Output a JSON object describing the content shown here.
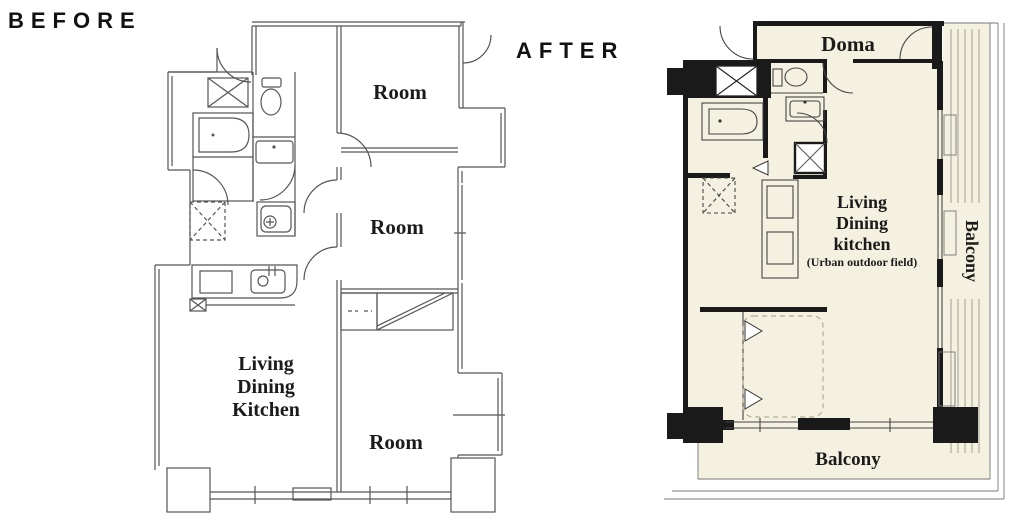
{
  "labels": {
    "before": "BEFORE",
    "after": "AFTER"
  },
  "before_plan": {
    "rooms": {
      "top": "Room",
      "middle": "Room",
      "bottom": "Room"
    },
    "ldk": [
      "Living",
      "Dining",
      "Kitchen"
    ]
  },
  "after_plan": {
    "doma": "Doma",
    "ldk": [
      "Living",
      "Dining",
      "kitchen",
      "(Urban outdoor field)"
    ],
    "balcony_right": "Balcony",
    "balcony_bottom": "Balcony"
  },
  "colors": {
    "canvas_bg": "#ffffff",
    "before_line": "#555555",
    "after_wall": "#1a1a1a",
    "after_floor": "#f5f1e0",
    "after_deck_line": "#9a968a"
  }
}
